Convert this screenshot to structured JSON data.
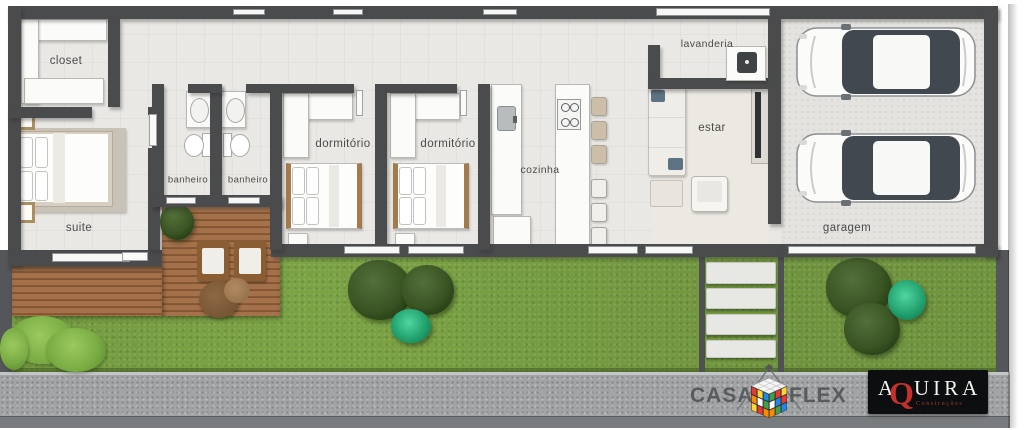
{
  "rooms": [
    {
      "name": "closet",
      "label": "closet"
    },
    {
      "name": "suite",
      "label": "suite"
    },
    {
      "name": "banheiro-1",
      "label": "banheiro"
    },
    {
      "name": "banheiro-2",
      "label": "banheiro"
    },
    {
      "name": "dormitorio-1",
      "label": "dormitório"
    },
    {
      "name": "dormitorio-2",
      "label": "dormitório"
    },
    {
      "name": "cozinha",
      "label": "cozinha"
    },
    {
      "name": "lavanderia",
      "label": "lavanderia"
    },
    {
      "name": "estar",
      "label": "estar"
    },
    {
      "name": "garagem",
      "label": "garagem"
    }
  ],
  "branding": {
    "casaflex": {
      "word_left": "CASA",
      "word_right": "FLEX"
    },
    "aquira": {
      "letter_a": "A",
      "letter_q": "Q",
      "letters_rest": "UIRA",
      "subtitle": "Construções"
    }
  },
  "colors": {
    "wall": "#4a4b4d",
    "floor": "#e9e8e4",
    "deck_wood": "#9b6c42",
    "grass": "#7ba344",
    "sidewalk": "#a2a4a6",
    "bush_dark": "#31501d",
    "bush_teal": "#2aa876",
    "logo_text": "#575c5f",
    "aquira_red": "#c4302b"
  }
}
